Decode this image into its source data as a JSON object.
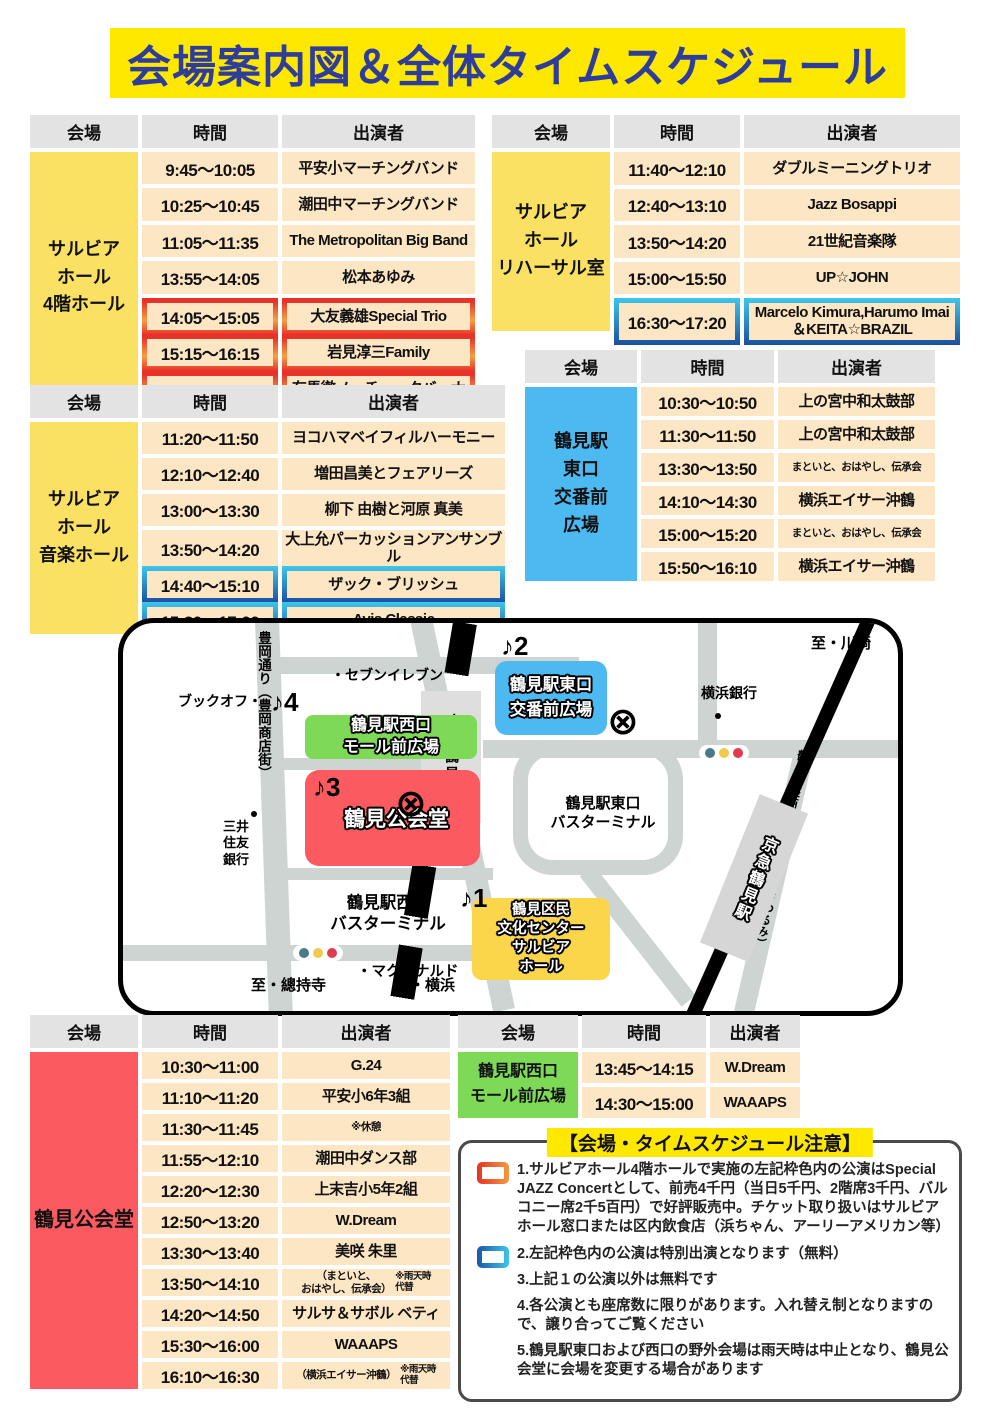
{
  "title": "会場案内図＆全体タイムスケジュール",
  "headers": {
    "venue": "会場",
    "time": "時間",
    "performer": "出演者"
  },
  "tables": {
    "hall4f": {
      "venue": "サルビア\nホール\n4階ホール",
      "rows": [
        {
          "time": "9:45～10:05",
          "performer": "平安小マーチングバンド"
        },
        {
          "time": "10:25～10:45",
          "performer": "潮田中マーチングバンド"
        },
        {
          "time": "11:05～11:35",
          "performer": "The Metropolitan Big Band"
        },
        {
          "time": "13:55～14:05",
          "performer": "松本あゆみ"
        },
        {
          "time": "14:05～15:05",
          "performer": "大友義雄Special Trio",
          "highlight": "red"
        },
        {
          "time": "15:15～16:15",
          "performer": "岩見淳三Family",
          "highlight": "red"
        },
        {
          "time": "16:25～17:25",
          "performer": "有馬徹ノーチェ・クバーナ",
          "highlight": "red"
        }
      ]
    },
    "rehearsal": {
      "venue": "サルビア\nホール\nリハーサル室",
      "rows": [
        {
          "time": "11:40～12:10",
          "performer": "ダブルミーニングトリオ"
        },
        {
          "time": "12:40～13:10",
          "performer": "Jazz Bosappi"
        },
        {
          "time": "13:50～14:20",
          "performer": "21世紀音楽隊"
        },
        {
          "time": "15:00～15:50",
          "performer": "UP☆JOHN"
        },
        {
          "time": "16:30～17:20",
          "performer": "Marcelo Kimura,Harumo Imai\n＆KEITA☆BRAZIL",
          "highlight": "blue"
        }
      ]
    },
    "music": {
      "venue": "サルビア\nホール\n音楽ホール",
      "rows": [
        {
          "time": "11:20～11:50",
          "performer": "ヨコハマベイフィルハーモニー"
        },
        {
          "time": "12:10～12:40",
          "performer": "増田昌美とフェアリーズ"
        },
        {
          "time": "13:00～13:30",
          "performer": "柳下 由樹と河原 真美"
        },
        {
          "time": "13:50～14:20",
          "performer": "大上允パーカッションアンサンブル"
        },
        {
          "time": "14:40～15:10",
          "performer": "ザック・ブリッシュ",
          "highlight": "blue"
        },
        {
          "time": "15:30～17:00",
          "performer": "Avis Classic",
          "highlight": "blue"
        }
      ]
    },
    "east_plaza": {
      "venue": "鶴見駅\n東口\n交番前\n広場",
      "rows": [
        {
          "time": "10:30～10:50",
          "performer": "上の宮中和太鼓部"
        },
        {
          "time": "11:30～11:50",
          "performer": "上の宮中和太鼓部"
        },
        {
          "time": "13:30～13:50",
          "performer": "まといと、おはやし、伝承会",
          "small": true
        },
        {
          "time": "14:10～14:30",
          "performer": "横浜エイサー沖鶴"
        },
        {
          "time": "15:00～15:20",
          "performer": "まといと、おはやし、伝承会",
          "small": true
        },
        {
          "time": "15:50～16:10",
          "performer": "横浜エイサー沖鶴"
        }
      ]
    },
    "public_hall": {
      "venue": "鶴見公会堂",
      "rows": [
        {
          "time": "10:30～11:00",
          "performer": "G.24"
        },
        {
          "time": "11:10～11:20",
          "performer": "平安小6年3組"
        },
        {
          "time": "11:30～11:45",
          "performer": "※休憩",
          "small": true
        },
        {
          "time": "11:55～12:10",
          "performer": "潮田中ダンス部"
        },
        {
          "time": "12:20～12:30",
          "performer": "上末吉小5年2組"
        },
        {
          "time": "12:50～13:20",
          "performer": "W.Dream"
        },
        {
          "time": "13:30～13:40",
          "performer": "美咲 朱里"
        },
        {
          "time": "13:50～14:10",
          "performer": "（まといと、\nおはやし、伝承会）",
          "note": "※雨天時\n代替",
          "small": true
        },
        {
          "time": "14:20～14:50",
          "performer": "サルサ＆サボル ベティ"
        },
        {
          "time": "15:30～16:00",
          "performer": "WAAAPS"
        },
        {
          "time": "16:10～16:30",
          "performer": "（横浜エイサー沖鶴）",
          "note": "※雨天時\n代替",
          "small": true
        }
      ]
    },
    "west_mall": {
      "venue": "鶴見駅西口\nモール前広場",
      "rows": [
        {
          "time": "13:45～14:15",
          "performer": "W.Dream"
        },
        {
          "time": "14:30～15:00",
          "performer": "WAAAPS"
        }
      ]
    }
  },
  "map": {
    "markers": {
      "m1": "♪1",
      "m2": "♪2",
      "m3": "♪3",
      "m4": "♪4"
    },
    "icons": {
      "crossing": "⊗"
    },
    "venues": {
      "east_plaza": "鶴見駅東口\n交番前広場",
      "west_mall": "鶴見駅西口\nモール前広場",
      "public_hall": "鶴見公会堂",
      "salvia": "鶴見区民\n文化センター\nサルビア\nホール"
    },
    "stations": {
      "jr": "ＪＲ鶴見駅",
      "keikyu": "京急鶴見駅"
    },
    "streets": {
      "toyooka": "豊岡通り（豊岡商店街）",
      "ginza": "鶴見銀座商店街（ベルロードつるみ）"
    },
    "pois": {
      "seven": "・セブンイレブン",
      "bookoff": "ブックオフ・",
      "bank": "横浜銀行",
      "mitsui": "三井\n住友\n銀行",
      "mcdonalds": "・マクドナルド"
    },
    "terminals": {
      "east": "鶴見駅東口\nバスターミナル",
      "west": "鶴見駅西口\nバスターミナル"
    },
    "directions": {
      "kawasaki": "至・川崎",
      "sojiji": "至・總持寺",
      "yokohama": "至・横浜"
    }
  },
  "notes": {
    "title": "【会場・タイムスケジュール注意】",
    "items": [
      {
        "swatch": "red",
        "text": "1.サルビアホール4階ホールで実施の左記枠色内の公演はSpecial JAZZ Concertとして、前売4千円（当日5千円、2階席3千円、バルコニー席2千5百円）で好評販売中。チケット取り扱いはサルビアホール窓口または区内飲食店（浜ちゃん、アーリーアメリカン等）"
      },
      {
        "swatch": "blue",
        "text": "2.左記枠色内の公演は特別出演となります（無料）"
      },
      {
        "text": "3.上記１の公演以外は無料です"
      },
      {
        "text": "4.各公演とも座席数に限りがあります。入れ替え制となりますので、譲り合ってご覧ください"
      },
      {
        "text": "5.鶴見駅東口および西口の野外会場は雨天時は中止となり、鶴見公会堂に会場を変更する場合があります"
      }
    ]
  },
  "colors": {
    "banner_yellow": "#FFE800",
    "title_blue": "#2E3D9B",
    "venue_yellow": "#FAE163",
    "venue_blue": "#4DB9F1",
    "venue_red": "#FA5A60",
    "venue_green": "#7ED957",
    "cell_peach": "#FDE6C4",
    "header_gray": "#E3E3E3",
    "highlight_red": "#E83229",
    "highlight_orange": "#F59F43",
    "highlight_blue_dark": "#1A4FA0",
    "highlight_cyan": "#3FC6EA",
    "road_gray": "#CDD4D1"
  }
}
